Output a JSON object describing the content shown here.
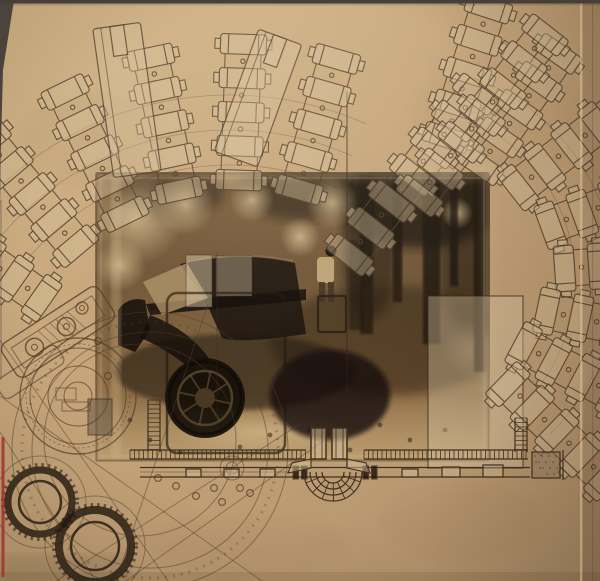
{
  "meta": {
    "kind": "photograph-of-album-artwork-collage",
    "width": 600,
    "height": 581,
    "description": "Sepia-toned art collage on tan paper: fanned technical drawings of cylinder chains across the top, a central vintage-car forest photograph, a watchmaker gear schematic in the lower left, a garden/terrace plan strip along the bottom, a red registration line on the left edge and a sleeve fold on the right edge."
  },
  "palette": {
    "paper_light": "#d3b588",
    "paper_mid": "#c5a479",
    "paper_dark": "#b2926c",
    "ink": "#4f3b28",
    "ink_dark": "#20170e",
    "photo_dark": "#1d140c",
    "photo_mid": "#7d5f3e",
    "photo_light": "#dcc192",
    "car_body": "#1b130c",
    "overlay_pale": "rgba(214,196,162,0.40)",
    "red_line": "#a5322d",
    "edge_dark": "#45403a",
    "fold_highlight": "#ddc194"
  },
  "photo": {
    "x": 95,
    "y": 172,
    "w": 395,
    "h": 290,
    "subject": "dark 1930s sedan parked in a forest clearing with a standing figure",
    "trunks": [
      [
        360,
        174,
        13,
        160
      ],
      [
        393,
        174,
        9,
        128
      ],
      [
        423,
        172,
        17,
        172
      ],
      [
        450,
        174,
        8,
        112
      ],
      [
        474,
        172,
        11,
        200
      ]
    ],
    "light_blobs": [
      [
        137,
        218,
        46
      ],
      [
        185,
        205,
        30
      ],
      [
        332,
        203,
        26
      ],
      [
        300,
        237,
        20
      ],
      [
        252,
        200,
        22
      ],
      [
        457,
        213,
        16
      ],
      [
        120,
        265,
        26
      ],
      [
        472,
        350,
        30
      ]
    ],
    "canopy": [
      [
        420,
        200,
        85,
        48,
        0.8
      ],
      [
        300,
        190,
        60,
        30,
        0.55
      ],
      [
        170,
        192,
        55,
        26,
        0.45
      ],
      [
        480,
        260,
        40,
        80,
        0.5
      ],
      [
        370,
        250,
        28,
        70,
        0.55
      ]
    ],
    "speckles": [
      [
        150,
        440
      ],
      [
        180,
        452
      ],
      [
        240,
        447
      ],
      [
        270,
        435
      ],
      [
        410,
        440
      ],
      [
        350,
        450
      ],
      [
        310,
        430
      ],
      [
        130,
        420
      ],
      [
        445,
        430
      ],
      [
        380,
        425
      ]
    ]
  },
  "fans": {
    "left": {
      "hub": [
        230,
        430
      ],
      "count": 5,
      "step": 34,
      "chains": [
        {
          "d": -145,
          "r0": 230
        },
        {
          "d": -130,
          "r0": 240
        },
        {
          "d": -116,
          "r0": 240
        },
        {
          "d": -102,
          "r0": 245
        },
        {
          "d": -88,
          "r0": 250
        },
        {
          "d": -74,
          "r0": 250
        }
      ],
      "arcs": {
        "radii": [
          265,
          300,
          335
        ],
        "a1": -140,
        "a2": -66
      }
    },
    "right": {
      "hub": [
        400,
        280
      ],
      "count": 5,
      "step": 34,
      "chains": [
        {
          "d": -72,
          "r0": 150
        },
        {
          "d": -55,
          "r0": 140
        },
        {
          "d": -38,
          "r0": 150
        },
        {
          "d": -20,
          "r0": 160
        },
        {
          "d": -4,
          "r0": 165
        },
        {
          "d": 12,
          "r0": 150
        },
        {
          "d": 28,
          "r0": 140
        },
        {
          "d": 44,
          "r0": 150
        }
      ],
      "arcs": {
        "radii": [
          175,
          215
        ],
        "a1": -70,
        "a2": 46
      }
    },
    "cross": [
      {
        "start": [
          350,
          255
        ],
        "d": -52,
        "count": 7
      },
      {
        "start": [
          545,
          35
        ],
        "d": 128,
        "count": 7
      }
    ],
    "towers": [
      {
        "cx": 127,
        "cy": 100,
        "w": 48,
        "h": 150,
        "rot": -8
      },
      {
        "cx": 258,
        "cy": 98,
        "w": 46,
        "h": 130,
        "rot": 20
      }
    ]
  },
  "watch": {
    "end_view": {
      "c": [
        78,
        396
      ],
      "radii": [
        58,
        48,
        30,
        14
      ]
    },
    "ring1": {
      "c": [
        40,
        502
      ],
      "outer": 32,
      "inner": 21
    },
    "ring2": {
      "c": [
        95,
        546
      ],
      "outer": 36,
      "inner": 24
    },
    "sweep_arcs": [
      [
        150,
        450,
        118
      ],
      [
        150,
        450,
        138
      ],
      [
        140,
        440,
        96
      ]
    ],
    "bolts": [
      [
        158,
        478
      ],
      [
        176,
        486
      ],
      [
        196,
        496
      ],
      [
        214,
        488
      ],
      [
        222,
        502
      ],
      [
        250,
        493
      ],
      [
        240,
        488
      ],
      [
        98,
        341
      ],
      [
        108,
        376
      ]
    ],
    "lines": [
      [
        0,
        340,
        168,
        581
      ],
      [
        0,
        396,
        262,
        581
      ],
      [
        56,
        581,
        300,
        424
      ],
      [
        126,
        581,
        330,
        436
      ],
      [
        208,
        304,
        116,
        581
      ],
      [
        0,
        432,
        96,
        581
      ]
    ]
  },
  "plan": {
    "hatch_segments": [
      [
        130,
        306
      ],
      [
        364,
        528
      ]
    ],
    "hatch_y": [
      450,
      459
    ],
    "rail_y": [
      467.5,
      477
    ],
    "rail_x": [
      140,
      530
    ],
    "h_blocks": [
      300,
      370
    ],
    "small_blocks": [
      [
        186,
        469,
        15,
        8
      ],
      [
        224,
        469,
        15,
        8
      ],
      [
        260,
        469,
        15,
        8
      ],
      [
        402,
        469,
        16,
        8
      ],
      [
        442,
        467,
        18,
        10
      ],
      [
        483,
        465,
        20,
        12
      ]
    ],
    "pillars": [
      [
        311,
        428,
        15,
        31
      ],
      [
        332,
        428,
        15,
        31
      ]
    ],
    "stair_center": [
      333,
      472
    ],
    "stair_radii": [
      11,
      17,
      23,
      29
    ],
    "vstrips": [
      [
        148,
        160,
        400,
        452
      ],
      [
        515,
        527,
        418,
        452
      ]
    ],
    "end_block": [
      532,
      452,
      28,
      26
    ]
  },
  "edges": {
    "red_line": {
      "x": 1.5,
      "y1": 437,
      "y2": 577
    },
    "fold_x": 580,
    "top_strip_h": 3.5,
    "left_wedge": "M0,0 L14,0 L3,70 L0.5,160 L0,220 Z"
  }
}
